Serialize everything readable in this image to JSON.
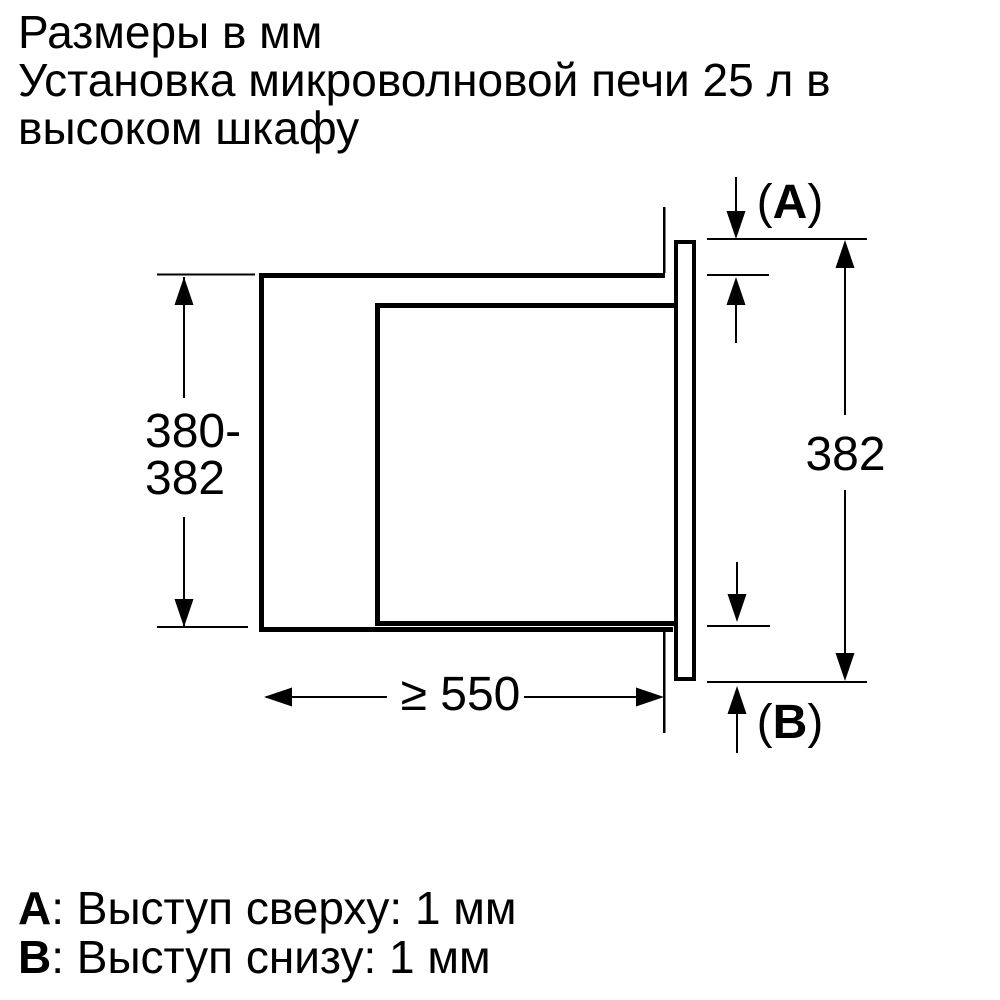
{
  "header": {
    "line1": "Размеры в мм",
    "line2": "Установка микроволновой печи 25 л в",
    "line3": "высоком шкафу"
  },
  "diagram": {
    "units": "мм",
    "dim_niche_height": {
      "line1": "380-",
      "line2": "382"
    },
    "dim_front_height": "382",
    "dim_min_depth": "≥ 550",
    "callout_top": {
      "open": "(",
      "letter": "A",
      "close": ")"
    },
    "callout_bottom": {
      "open": "(",
      "letter": "B",
      "close": ")"
    },
    "colors": {
      "line": "#000000",
      "background": "#ffffff"
    }
  },
  "legend": {
    "items": [
      {
        "letter": "A",
        "text": ": Выступ сверху: 1 мм"
      },
      {
        "letter": "B",
        "text": ": Выступ снизу: 1 мм"
      }
    ]
  }
}
